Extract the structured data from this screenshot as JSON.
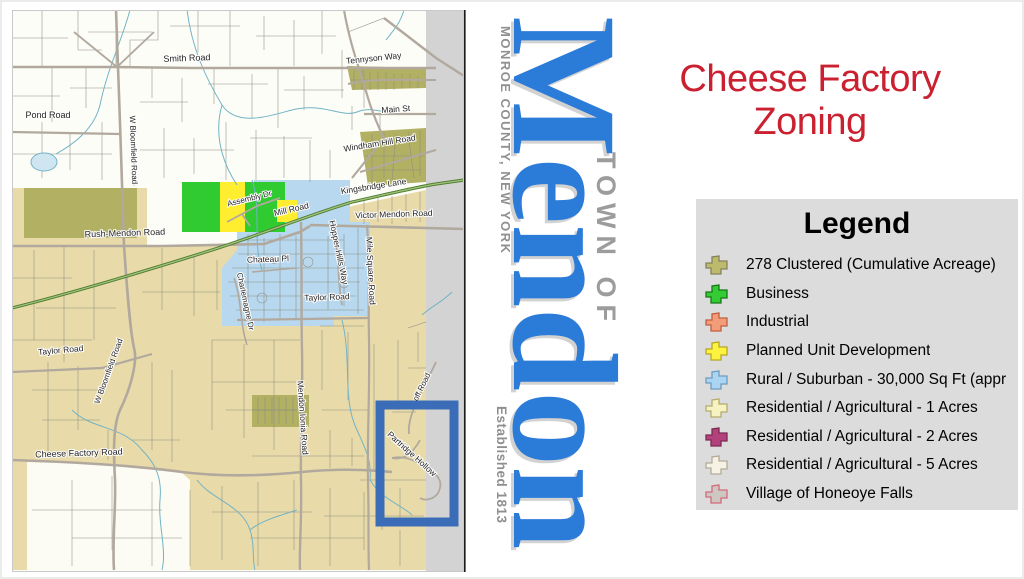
{
  "title": {
    "line1": "Cheese Factory",
    "line2": "Zoning",
    "color": "#cb2030"
  },
  "logo": {
    "monroe": "MONROE COUNTY, NEW YORK",
    "name": "Mendon",
    "town_of": "TOWN OF",
    "established": "Established 1813",
    "blue": "#2b7bd9",
    "gray": "#8f8f8f"
  },
  "legend": {
    "title": "Legend",
    "bg": "#dcdcdc",
    "items": [
      {
        "label": "278 Clustered (Cumulative Acreage)",
        "fill": "#bdba6d",
        "stroke": "#85825a"
      },
      {
        "label": "Business",
        "fill": "#35cb35",
        "stroke": "#157a15"
      },
      {
        "label": "Industrial",
        "fill": "#f29c79",
        "stroke": "#c05f3e"
      },
      {
        "label": "Planned Unit Development",
        "fill": "#fdf23e",
        "stroke": "#b7a81f"
      },
      {
        "label": "Rural / Suburban - 30,000 Sq Ft (appr",
        "fill": "#aad4f0",
        "stroke": "#6d9cc2"
      },
      {
        "label": "Residential / Agricultural - 1 Acres",
        "fill": "#f6f2c1",
        "stroke": "#b5ad6d"
      },
      {
        "label": "Residential / Agricultural - 2 Acres",
        "fill": "#b2417c",
        "stroke": "#7c2a52"
      },
      {
        "label": "Residential / Agricultural - 5 Acres",
        "fill": "#f6f2e6",
        "stroke": "#b3ab97"
      },
      {
        "label": "Village of Honeoye Falls",
        "fill": "#cdc7c1",
        "stroke": "#d4697b"
      }
    ]
  },
  "map": {
    "colors": {
      "beige": "#e9dba9",
      "white_zone": "#fdfdf7",
      "rural_blue": "#b7d8ee",
      "olive": "#b2b063",
      "business_green": "#2fcb30",
      "pud_yellow": "#ffee30",
      "boundary_band": "#d3d3d3",
      "stream": "#72b3c6",
      "road": "#b1a89e",
      "trail_green": "#4f7d33",
      "highlight_box": "#3a6cb8"
    },
    "labels": [
      {
        "text": "Smith Road",
        "x": 175,
        "y": 51,
        "r": -2,
        "fs": 9
      },
      {
        "text": "Pond Road",
        "x": 36,
        "y": 108,
        "r": 0,
        "fs": 9
      },
      {
        "text": "Tennyson Way",
        "x": 362,
        "y": 51,
        "r": -6,
        "fs": 8.5
      },
      {
        "text": "Main St",
        "x": 384,
        "y": 102,
        "r": -4,
        "fs": 8.5
      },
      {
        "text": "Windham Hill Road",
        "x": 368,
        "y": 136,
        "r": -9,
        "fs": 8.5
      },
      {
        "text": "Kingsbridge Lane",
        "x": 362,
        "y": 179,
        "r": -9,
        "fs": 8.5
      },
      {
        "text": "Victor Mendon Road",
        "x": 382,
        "y": 207,
        "r": -2,
        "fs": 8.5
      },
      {
        "text": "Rush-Mendon Road",
        "x": 113,
        "y": 226,
        "r": -2,
        "fs": 9
      },
      {
        "text": "Assembly Dr",
        "x": 238,
        "y": 191,
        "r": -14,
        "fs": 8
      },
      {
        "text": "Mill Road",
        "x": 280,
        "y": 202,
        "r": -13,
        "fs": 8.5
      },
      {
        "text": "Hopper Hills Way",
        "x": 324,
        "y": 243,
        "r": 78,
        "fs": 8.5
      },
      {
        "text": "Chateau Pl",
        "x": 256,
        "y": 252,
        "r": -2,
        "fs": 8.5
      },
      {
        "text": "Charlemagne Dr",
        "x": 231,
        "y": 292,
        "r": 78,
        "fs": 8
      },
      {
        "text": "Mile Square Road",
        "x": 356,
        "y": 261,
        "r": 87,
        "fs": 8.5
      },
      {
        "text": "Taylor Road",
        "x": 315,
        "y": 290,
        "r": -2,
        "fs": 8.5
      },
      {
        "text": "Taylor Road",
        "x": 49,
        "y": 343,
        "r": -5,
        "fs": 8.5
      },
      {
        "text": "W Bloomfield Road",
        "x": 119,
        "y": 140,
        "r": 88,
        "fs": 8
      },
      {
        "text": "W Bloomfield Road",
        "x": 99,
        "y": 362,
        "r": -70,
        "fs": 8
      },
      {
        "text": "Mendon Ionia Road",
        "x": 288,
        "y": 408,
        "r": 86,
        "fs": 8.5
      },
      {
        "text": "Cheese Factory Road",
        "x": 67,
        "y": 446,
        "r": -2,
        "fs": 9
      },
      {
        "text": "Partridge Hollow",
        "x": 398,
        "y": 446,
        "r": 42,
        "fs": 8.5
      },
      {
        "text": "off Road",
        "x": 412,
        "y": 378,
        "r": -64,
        "fs": 8
      }
    ]
  }
}
